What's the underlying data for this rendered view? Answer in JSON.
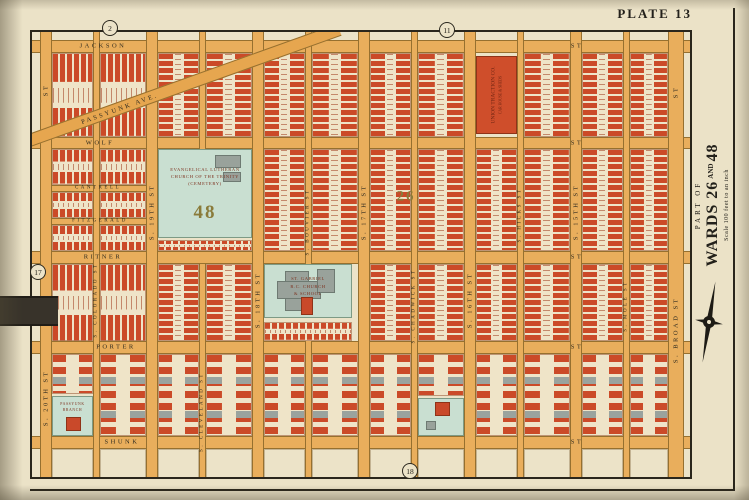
{
  "page": {
    "plate_label": "PLATE 13",
    "margin": {
      "part_of": "PART OF",
      "wards_a": "WARDS 26",
      "and": "AND",
      "wards_b": "48",
      "scale": "Scale 100 feet to an inch"
    }
  },
  "colors": {
    "paper": "#ebe2c7",
    "street": "#e9ae5c",
    "brick": "#cb4a28",
    "teal_parcel": "#c9dfd1",
    "gray_building": "#99a29b",
    "ward_number": "#8a7b3a"
  },
  "map": {
    "streets_h": [
      {
        "id": "jackson-st",
        "x1": 30,
        "x2": 692,
        "y": 40,
        "h": 13
      },
      {
        "id": "wolf-st",
        "x1": 30,
        "x2": 692,
        "y": 137,
        "h": 12
      },
      {
        "id": "cantrell-st",
        "x1": 40,
        "x2": 252,
        "y": 185,
        "h": 7
      },
      {
        "id": "fitzgerald-st",
        "x1": 40,
        "x2": 252,
        "y": 218,
        "h": 7
      },
      {
        "id": "ritner-st",
        "x1": 30,
        "x2": 692,
        "y": 251,
        "h": 13
      },
      {
        "id": "porter-st",
        "x1": 30,
        "x2": 692,
        "y": 341,
        "h": 13
      },
      {
        "id": "shunk-st",
        "x1": 30,
        "x2": 692,
        "y": 436,
        "h": 13
      }
    ],
    "streets_v": [
      {
        "id": "s-20th-st",
        "x": 40,
        "w": 12,
        "segs": [
          [
            30,
            479
          ]
        ]
      },
      {
        "id": "s-colorado-st",
        "x": 93,
        "w": 7,
        "segs": [
          [
            30,
            479
          ]
        ]
      },
      {
        "id": "s-19th-st",
        "x": 146,
        "w": 12,
        "segs": [
          [
            30,
            479
          ]
        ]
      },
      {
        "id": "s-cleveland-st",
        "x": 199,
        "w": 7,
        "segs": [
          [
            30,
            149
          ],
          [
            264,
            479
          ]
        ]
      },
      {
        "id": "s-18th-st",
        "x": 252,
        "w": 12,
        "segs": [
          [
            30,
            479
          ]
        ]
      },
      {
        "id": "s-bouvier-st",
        "x": 305,
        "w": 7,
        "segs": [
          [
            30,
            264
          ],
          [
            341,
            479
          ]
        ]
      },
      {
        "id": "s-17th-st",
        "x": 358,
        "w": 12,
        "segs": [
          [
            30,
            479
          ]
        ]
      },
      {
        "id": "s-chadwick-st",
        "x": 411,
        "w": 7,
        "segs": [
          [
            30,
            479
          ]
        ]
      },
      {
        "id": "s-16th-st",
        "x": 464,
        "w": 12,
        "segs": [
          [
            30,
            479
          ]
        ]
      },
      {
        "id": "s-hicks-st",
        "x": 517,
        "w": 7,
        "segs": [
          [
            30,
            479
          ]
        ]
      },
      {
        "id": "s-15th-st",
        "x": 570,
        "w": 12,
        "segs": [
          [
            30,
            479
          ]
        ]
      },
      {
        "id": "s-mole-st",
        "x": 623,
        "w": 7,
        "segs": [
          [
            30,
            479
          ]
        ]
      },
      {
        "id": "s-broad-st",
        "x": 668,
        "w": 16,
        "segs": [
          [
            30,
            479
          ]
        ]
      }
    ],
    "diagonal": {
      "id": "passyunk-ave",
      "cx": 183,
      "cy": 85,
      "len": 332,
      "w": 13,
      "angle": -19.7
    },
    "blocks": [
      [
        52,
        53,
        41,
        84,
        "h"
      ],
      [
        100,
        53,
        46,
        84,
        "h"
      ],
      [
        158,
        53,
        41,
        84,
        "v"
      ],
      [
        206,
        53,
        46,
        84,
        "v"
      ],
      [
        264,
        53,
        41,
        84,
        "v"
      ],
      [
        312,
        53,
        46,
        84,
        "v"
      ],
      [
        370,
        53,
        41,
        84,
        "v"
      ],
      [
        418,
        53,
        46,
        84,
        "v"
      ],
      [
        524,
        53,
        46,
        84,
        "v"
      ],
      [
        582,
        53,
        41,
        84,
        "v"
      ],
      [
        630,
        53,
        38,
        84,
        "v"
      ],
      [
        52,
        149,
        41,
        36,
        "h"
      ],
      [
        52,
        192,
        41,
        26,
        "h"
      ],
      [
        52,
        225,
        41,
        26,
        "h"
      ],
      [
        100,
        149,
        46,
        36,
        "h"
      ],
      [
        100,
        192,
        46,
        26,
        "h"
      ],
      [
        100,
        225,
        46,
        26,
        "h"
      ],
      [
        158,
        240,
        94,
        11,
        "h"
      ],
      [
        264,
        149,
        41,
        102,
        "v"
      ],
      [
        312,
        149,
        46,
        102,
        "v"
      ],
      [
        370,
        149,
        41,
        102,
        "v"
      ],
      [
        418,
        149,
        46,
        102,
        "v"
      ],
      [
        476,
        149,
        41,
        102,
        "v"
      ],
      [
        524,
        149,
        46,
        102,
        "v"
      ],
      [
        582,
        149,
        41,
        102,
        "v"
      ],
      [
        630,
        149,
        38,
        102,
        "v"
      ],
      [
        52,
        264,
        41,
        77,
        "h"
      ],
      [
        100,
        264,
        46,
        77,
        "h"
      ],
      [
        158,
        264,
        41,
        77,
        "v"
      ],
      [
        206,
        264,
        46,
        77,
        "v"
      ],
      [
        264,
        322,
        88,
        19,
        "h"
      ],
      [
        370,
        264,
        41,
        77,
        "v"
      ],
      [
        418,
        264,
        46,
        77,
        "v"
      ],
      [
        476,
        264,
        41,
        77,
        "v"
      ],
      [
        524,
        264,
        46,
        77,
        "v"
      ],
      [
        582,
        264,
        41,
        77,
        "v"
      ],
      [
        630,
        264,
        38,
        77,
        "v"
      ],
      [
        52,
        354,
        41,
        40,
        "d"
      ],
      [
        100,
        354,
        46,
        82,
        "d"
      ],
      [
        158,
        354,
        41,
        82,
        "d"
      ],
      [
        206,
        354,
        46,
        82,
        "d"
      ],
      [
        264,
        354,
        41,
        82,
        "d"
      ],
      [
        312,
        354,
        46,
        82,
        "d"
      ],
      [
        370,
        354,
        41,
        82,
        "d"
      ],
      [
        418,
        354,
        46,
        42,
        "d"
      ],
      [
        476,
        354,
        41,
        82,
        "d"
      ],
      [
        524,
        354,
        46,
        82,
        "d"
      ],
      [
        582,
        354,
        41,
        82,
        "d"
      ],
      [
        630,
        354,
        38,
        82,
        "d"
      ],
      [
        52,
        449,
        41,
        30,
        "e"
      ],
      [
        100,
        449,
        46,
        30,
        "e"
      ],
      [
        158,
        449,
        41,
        30,
        "e"
      ],
      [
        206,
        449,
        46,
        30,
        "e"
      ],
      [
        264,
        449,
        41,
        30,
        "e"
      ],
      [
        312,
        449,
        46,
        30,
        "e"
      ],
      [
        370,
        449,
        41,
        30,
        "e"
      ],
      [
        418,
        449,
        46,
        30,
        "e"
      ],
      [
        476,
        449,
        41,
        30,
        "e"
      ],
      [
        524,
        449,
        46,
        30,
        "e"
      ],
      [
        582,
        449,
        41,
        30,
        "e"
      ],
      [
        630,
        449,
        38,
        30,
        "e"
      ]
    ],
    "sites": [
      {
        "name": "trinity-lutheran-cemetery",
        "kind": "teal",
        "x": 158,
        "y": 149,
        "w": 94,
        "h": 89,
        "lines": [
          "EVANGELICAL LUTHERAN",
          "CHURCH OF THE TRINITY",
          "(CEMETERY)"
        ],
        "ls": 4.6,
        "ly": 18,
        "num": "48",
        "ns": 19,
        "ny": 72,
        "buildings": [
          {
            "c": "gb",
            "x": 56,
            "y": 5,
            "w": 26,
            "h": 13
          },
          {
            "c": "gb",
            "x": 64,
            "y": 22,
            "w": 18,
            "h": 10
          }
        ]
      },
      {
        "name": "st-gabriel-rc-church",
        "kind": "teal",
        "x": 264,
        "y": 264,
        "w": 88,
        "h": 54,
        "buildings": [
          {
            "c": "gb",
            "x": 20,
            "y": 6,
            "w": 24,
            "h": 40
          },
          {
            "c": "gb",
            "x": 12,
            "y": 16,
            "w": 44,
            "h": 18
          },
          {
            "c": "gb",
            "x": 52,
            "y": 4,
            "w": 18,
            "h": 24
          },
          {
            "c": "rb",
            "x": 36,
            "y": 32,
            "w": 12,
            "h": 18
          }
        ],
        "lines": [
          "ST. GABRIEL",
          "R.C. CHURCH",
          "& SCHOOL"
        ],
        "ls": 4.6,
        "ly": 20
      },
      {
        "name": "union-traction-car-house",
        "kind": "red",
        "x": 476,
        "y": 56,
        "w": 41,
        "h": 78,
        "vlines": [
          "UNION TRACTION CO.",
          "CAR HOUSE & SHEDS"
        ]
      },
      {
        "name": "passyunk-branch-parcel",
        "kind": "teal",
        "x": 52,
        "y": 396,
        "w": 41,
        "h": 40,
        "lines": [
          "PASSYUNK",
          "BRANCH"
        ],
        "ls": 3.8,
        "ly": 10,
        "buildings": [
          {
            "c": "rb",
            "x": 13,
            "y": 20,
            "w": 15,
            "h": 14
          }
        ]
      },
      {
        "name": "green-parcel",
        "kind": "teal",
        "x": 418,
        "y": 398,
        "w": 46,
        "h": 38,
        "buildings": [
          {
            "c": "rb",
            "x": 16,
            "y": 3,
            "w": 15,
            "h": 14
          },
          {
            "c": "gb",
            "x": 7,
            "y": 22,
            "w": 10,
            "h": 9
          }
        ]
      }
    ],
    "labels": [
      {
        "t": "JACKSON",
        "x": 103,
        "y": 46
      },
      {
        "t": "ST",
        "x": 577,
        "y": 46
      },
      {
        "t": "WOLF",
        "x": 100,
        "y": 143
      },
      {
        "t": "ST",
        "x": 577,
        "y": 143
      },
      {
        "t": "CANTRELL",
        "x": 98,
        "y": 188,
        "s": 5
      },
      {
        "t": "FITZGERALD",
        "x": 100,
        "y": 221,
        "s": 5
      },
      {
        "t": "RITNER",
        "x": 103,
        "y": 257
      },
      {
        "t": "ST",
        "x": 577,
        "y": 257
      },
      {
        "t": "PORTER",
        "x": 116,
        "y": 347
      },
      {
        "t": "ST",
        "x": 577,
        "y": 347
      },
      {
        "t": "SHUNK",
        "x": 122,
        "y": 442
      },
      {
        "t": "ST",
        "x": 577,
        "y": 442
      },
      {
        "t": "PASSYUNK AVE.",
        "x": 120,
        "y": 109,
        "v": 2
      },
      {
        "t": "S. 20TH ST",
        "x": 46,
        "y": 398,
        "v": 1
      },
      {
        "t": "ST",
        "x": 46,
        "y": 90,
        "v": 1
      },
      {
        "t": "S. COLORADO ST",
        "x": 96,
        "y": 300,
        "v": 1,
        "s": 5
      },
      {
        "t": "S. 19TH ST",
        "x": 152,
        "y": 212,
        "v": 1
      },
      {
        "t": "S. CLEVELAND ST",
        "x": 202,
        "y": 412,
        "v": 1,
        "s": 5
      },
      {
        "t": "S. 18TH ST",
        "x": 258,
        "y": 300,
        "v": 1
      },
      {
        "t": "S. BOUVIER ST",
        "x": 308,
        "y": 222,
        "v": 1,
        "s": 5
      },
      {
        "t": "S. 17TH ST",
        "x": 364,
        "y": 212,
        "v": 1
      },
      {
        "t": "S. CHADWICK ST",
        "x": 414,
        "y": 306,
        "v": 1,
        "s": 5
      },
      {
        "t": "S. 16TH ST",
        "x": 470,
        "y": 300,
        "v": 1
      },
      {
        "t": "S. HICKS ST",
        "x": 520,
        "y": 215,
        "v": 1,
        "s": 5
      },
      {
        "t": "S. 15TH ST",
        "x": 576,
        "y": 212,
        "v": 1
      },
      {
        "t": "S. MOLE ST",
        "x": 626,
        "y": 306,
        "v": 1,
        "s": 5
      },
      {
        "t": "S. BROAD ST",
        "x": 676,
        "y": 330,
        "v": 1
      },
      {
        "t": "ST",
        "x": 676,
        "y": 92,
        "v": 1
      }
    ],
    "wards": [
      {
        "t": "26",
        "x": 406,
        "y": 197,
        "s": 15
      }
    ],
    "plate_refs": [
      {
        "t": "2",
        "x": 110,
        "y": 28
      },
      {
        "t": "11",
        "x": 447,
        "y": 30
      },
      {
        "t": "17",
        "x": 38,
        "y": 272
      },
      {
        "t": "18",
        "x": 410,
        "y": 471
      }
    ]
  }
}
